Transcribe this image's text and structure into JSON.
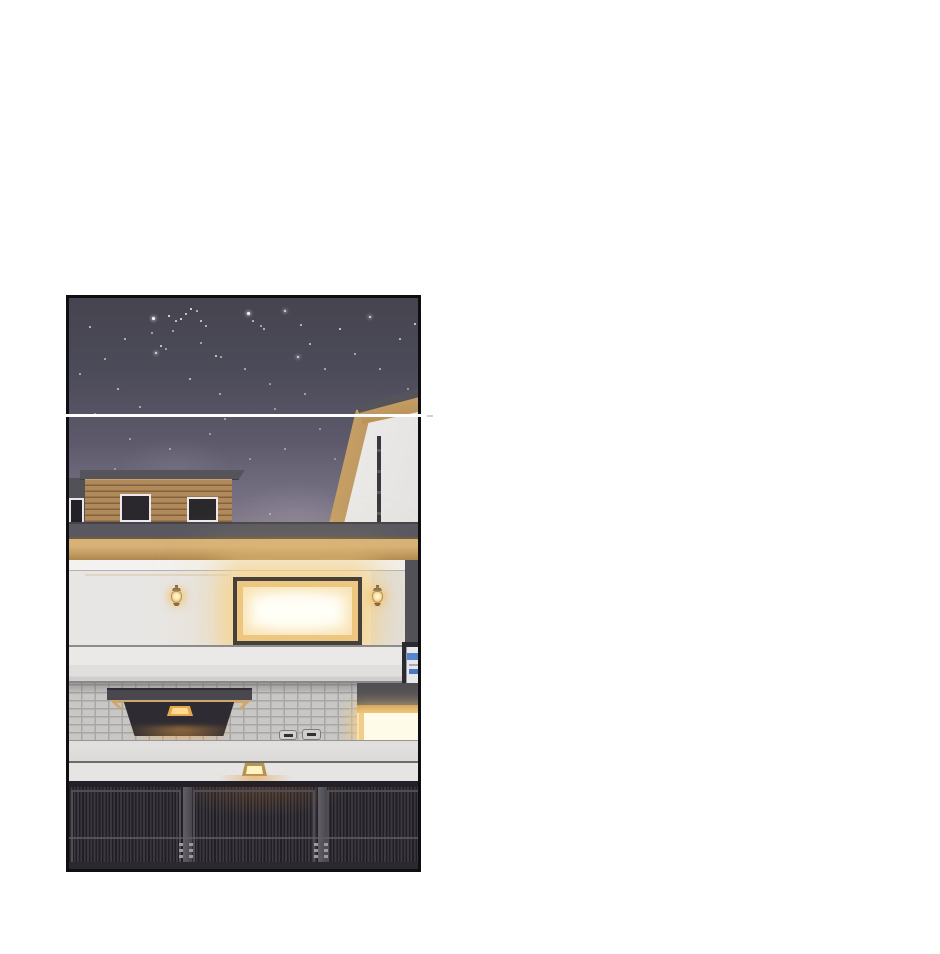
{
  "scene": {
    "kind": "webtoon-panel",
    "content": "night exterior of modern house with lit windows, entrance canopy and metal gate"
  },
  "palette": {
    "page_bg": "#ffffff",
    "panel_border": "#0f0f11",
    "seam": "#ffffff",
    "sky_top": "#45444f",
    "sky_mid": "#5e5a6c",
    "sky_horizon": "#8a8394",
    "star": "#f5f4fa",
    "roof_cap": "#55545b",
    "trim_tan": "#cda76c",
    "wood": "#b18a5c",
    "wood_dark": "#83613c",
    "dark_wall": "#525157",
    "parapet": "#595860",
    "cornice": "#d7b177",
    "wall_white": "#efedeb",
    "window_frame": "#46403c",
    "window_light": "#fffef5",
    "window_glow": "#f2cd87",
    "lantern_gold": "#b8924f",
    "lamp_amber": "#e8a84e",
    "brick_face": "#c8c7c5",
    "brick_mortar": "#a8a7a5",
    "lower_wall": "#e6e5e3",
    "canopy_dark": "#4a484e",
    "gate_bg": "#3b393f",
    "gate_slat": "#211f25",
    "gate_rail": "#232127",
    "intercom_blue": "#5584d0"
  },
  "stars": [
    [
      83,
      19,
      2.5,
      1
    ],
    [
      99,
      17,
      1.5,
      0.9
    ],
    [
      106,
      22,
      1.5,
      0.8
    ],
    [
      111,
      20,
      1.5,
      0.9
    ],
    [
      116,
      15,
      1.5,
      0.8
    ],
    [
      121,
      10,
      1.5,
      0.9
    ],
    [
      127,
      12,
      1.5,
      0.7
    ],
    [
      131,
      22,
      1.5,
      0.8
    ],
    [
      136,
      27,
      1.5,
      0.7
    ],
    [
      103,
      32,
      1.5,
      0.6
    ],
    [
      91,
      47,
      1.5,
      0.8
    ],
    [
      96,
      50,
      1.5,
      0.6
    ],
    [
      86,
      54,
      2,
      0.9
    ],
    [
      131,
      44,
      1.5,
      0.6
    ],
    [
      146,
      57,
      1.5,
      0.8
    ],
    [
      151,
      58,
      1.5,
      0.6
    ],
    [
      178,
      14,
      2.5,
      1
    ],
    [
      183,
      22,
      1.5,
      0.7
    ],
    [
      191,
      27,
      1.5,
      0.6
    ],
    [
      194,
      30,
      1.5,
      0.7
    ],
    [
      215,
      12,
      2,
      0.9
    ],
    [
      228,
      58,
      2,
      0.9
    ],
    [
      231,
      26,
      1.5,
      0.7
    ],
    [
      82,
      34,
      1.5,
      0.6
    ],
    [
      20,
      28,
      1.5,
      0.7
    ],
    [
      35,
      60,
      1.5,
      0.6
    ],
    [
      55,
      40,
      1.5,
      0.7
    ],
    [
      10,
      75,
      1.5,
      0.6
    ],
    [
      48,
      90,
      1.5,
      0.7
    ],
    [
      70,
      108,
      1.5,
      0.6
    ],
    [
      25,
      115,
      1.5,
      0.5
    ],
    [
      150,
      95,
      1.5,
      0.6
    ],
    [
      120,
      80,
      1.5,
      0.7
    ],
    [
      175,
      70,
      1.5,
      0.6
    ],
    [
      200,
      85,
      1.5,
      0.5
    ],
    [
      240,
      45,
      1.5,
      0.7
    ],
    [
      255,
      70,
      1.5,
      0.6
    ],
    [
      270,
      30,
      1.5,
      0.8
    ],
    [
      285,
      55,
      1.5,
      0.6
    ],
    [
      300,
      18,
      2,
      0.9
    ],
    [
      310,
      70,
      1.5,
      0.6
    ],
    [
      330,
      40,
      1.5,
      0.7
    ],
    [
      345,
      25,
      1.5,
      0.8
    ],
    [
      338,
      90,
      1.5,
      0.5
    ],
    [
      60,
      140,
      1.5,
      0.5
    ],
    [
      100,
      150,
      1.5,
      0.5
    ],
    [
      140,
      135,
      1.5,
      0.5
    ],
    [
      180,
      160,
      1.5,
      0.45
    ],
    [
      215,
      150,
      1.5,
      0.5
    ],
    [
      250,
      130,
      1.5,
      0.45
    ],
    [
      290,
      120,
      1.5,
      0.5
    ],
    [
      120,
      185,
      1.5,
      0.4
    ],
    [
      160,
      200,
      1.5,
      0.4
    ],
    [
      200,
      215,
      1.5,
      0.45
    ],
    [
      230,
      235,
      1.2,
      0.4
    ],
    [
      185,
      250,
      1.2,
      0.35
    ],
    [
      205,
      252,
      1.2,
      0.35
    ],
    [
      90,
      200,
      1.5,
      0.4
    ],
    [
      45,
      170,
      1.5,
      0.4
    ],
    [
      310,
      140,
      1.5,
      0.45
    ],
    [
      265,
      160,
      1.5,
      0.4
    ],
    [
      155,
      120,
      1.5,
      0.55
    ],
    [
      205,
      110,
      1.5,
      0.5
    ],
    [
      235,
      95,
      1.5,
      0.55
    ]
  ]
}
